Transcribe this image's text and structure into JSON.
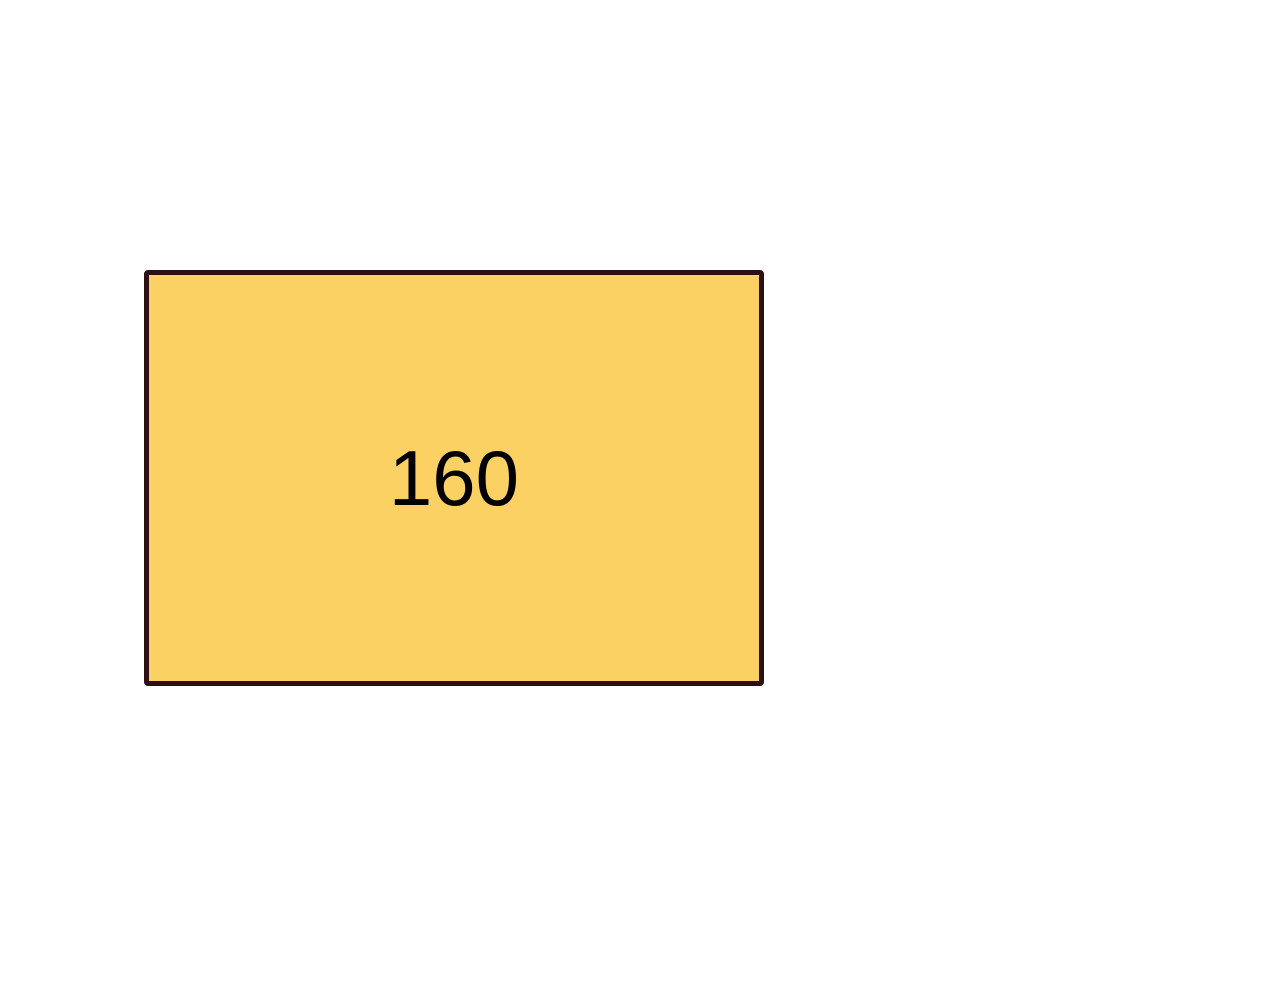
{
  "canvas": {
    "background_color": "#ffffff"
  },
  "rectangle": {
    "label": "160",
    "fill_color": "#FBD164",
    "border_color": "#2D1016",
    "text_color": "#000000"
  }
}
